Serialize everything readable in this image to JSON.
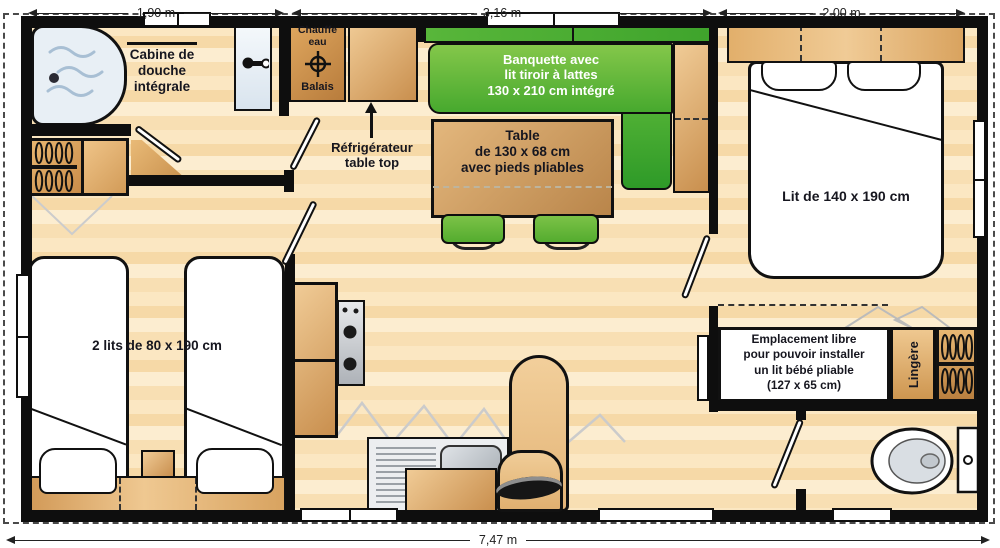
{
  "dimensions": {
    "left_width": "1,90 m",
    "middle_width": "3,16 m",
    "right_width": "2,00 m",
    "total_length": "7,47 m"
  },
  "labels": {
    "shower": [
      "Cabine de",
      "douche",
      "intégrale"
    ],
    "water_heater": [
      "Chauffe",
      "eau"
    ],
    "broom": "Balais",
    "banquette": [
      "Banquette avec",
      "lit tiroir à lattes",
      "130 x 210 cm intégré"
    ],
    "fridge": [
      "Réfrigérateur",
      "table top"
    ],
    "table": [
      "Table",
      "de 130 x 68 cm",
      "avec pieds pliables"
    ],
    "double_bed": "Lit de 140 x 190 cm",
    "twin_beds": "2 lits de 80 x 190 cm",
    "baby_space": [
      "Emplacement libre",
      "pour pouvoir installer",
      "un lit bébé pliable",
      "(127 x 65 cm)"
    ],
    "linen_closet": "Lingère"
  },
  "colors": {
    "wall": "#0e0e0e",
    "floor_light": "#FBE7C2",
    "floor_dark": "#F2D49E",
    "wood": "#D9A258",
    "bench_green": "#5BB637",
    "shower_blue": "#E8EFF5",
    "label_text": "#16161f"
  }
}
